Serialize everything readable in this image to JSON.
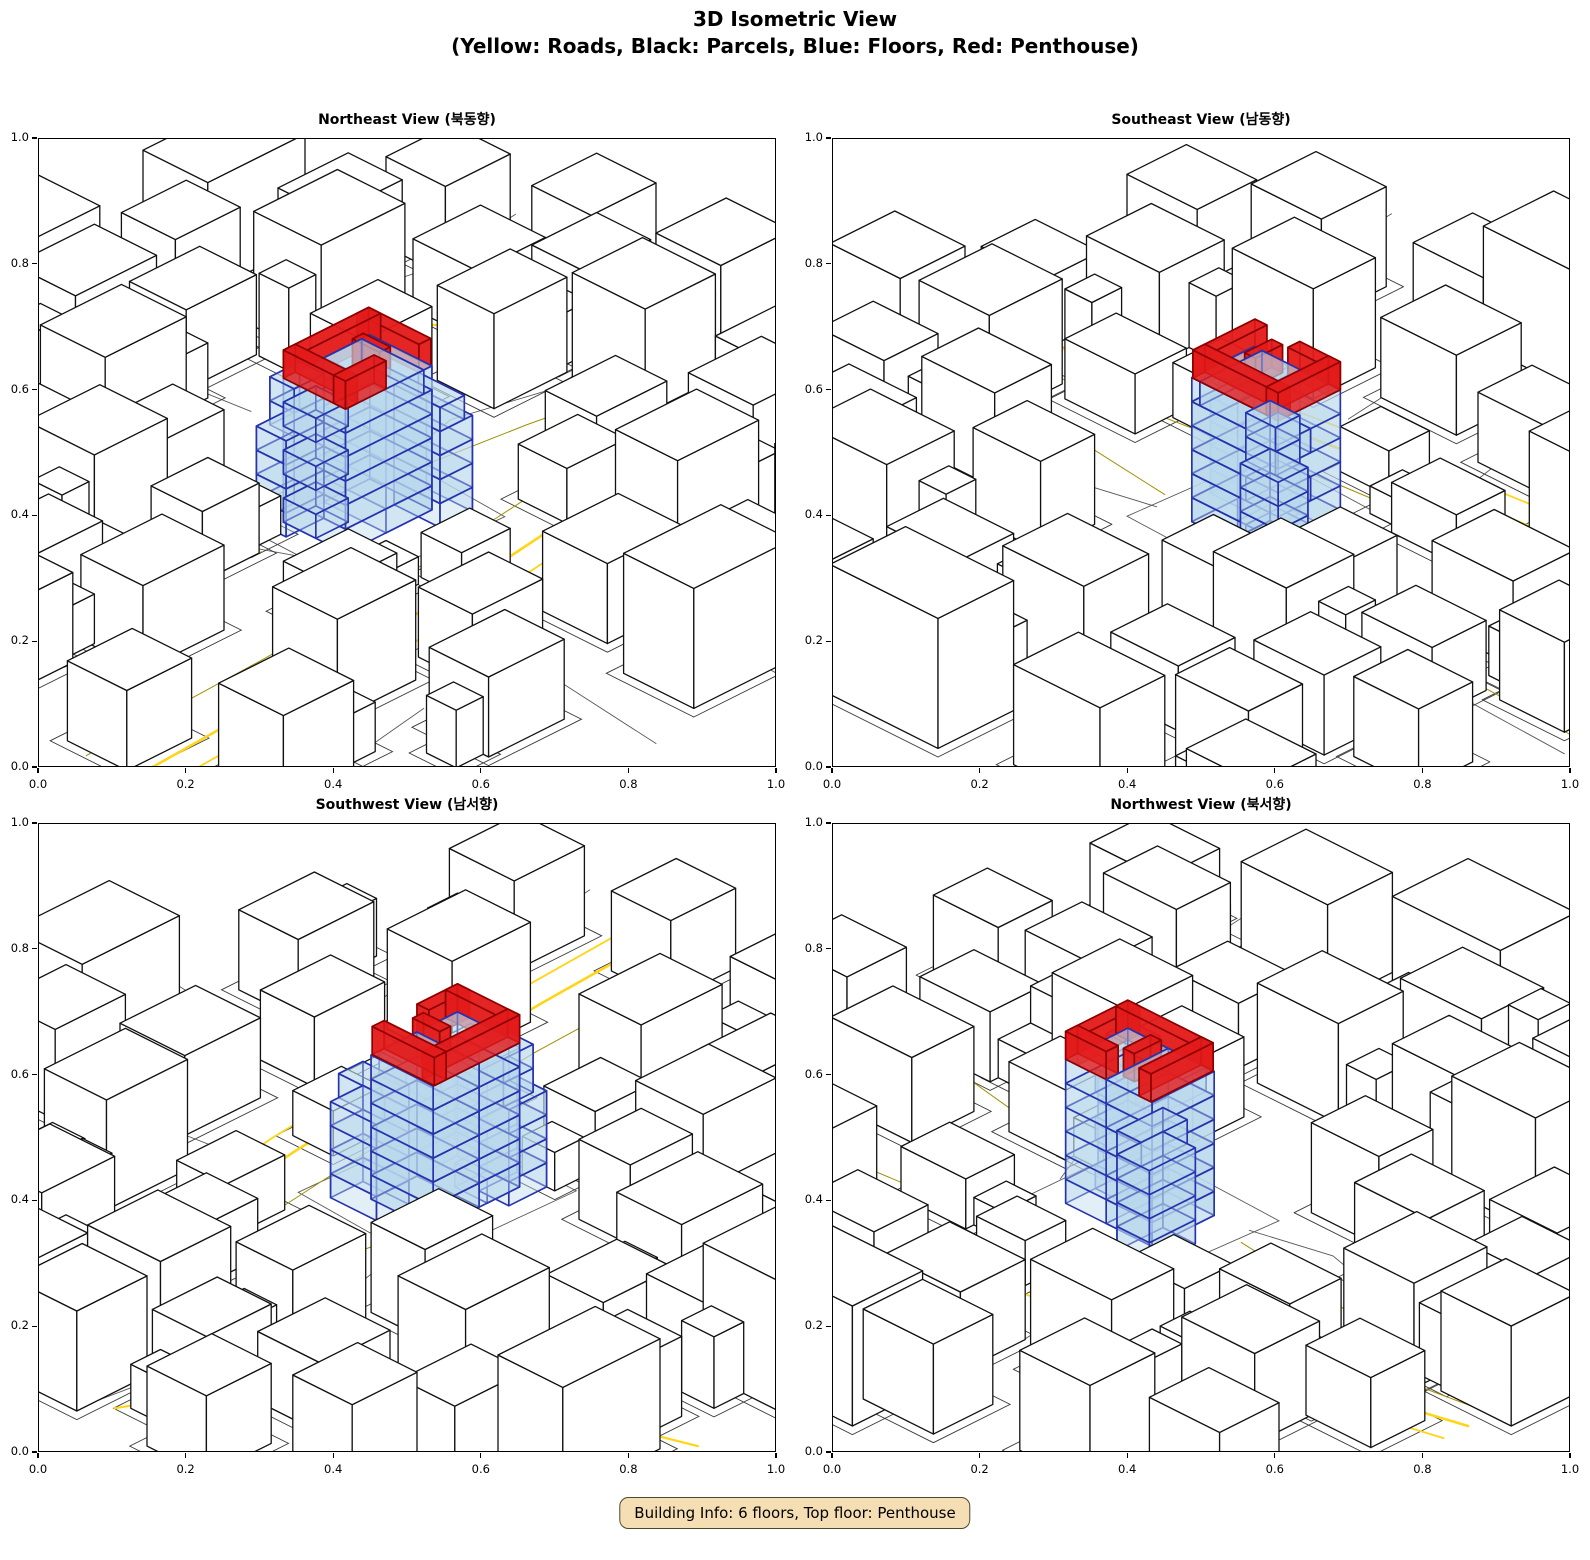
{
  "figure": {
    "title_line1": "3D Isometric View",
    "title_line2": "(Yellow: Roads, Black: Parcels, Blue: Floors, Red: Penthouse)",
    "footer_badge": "Building Info: 6 floors, Top floor: Penthouse"
  },
  "building_info": {
    "floors": 6,
    "top_floor": "Penthouse"
  },
  "subplots": [
    {
      "title": "Northeast View (북동향)",
      "view": "northeast"
    },
    {
      "title": "Southeast View (남동향)",
      "view": "southeast"
    },
    {
      "title": "Southwest View (남서향)",
      "view": "southwest"
    },
    {
      "title": "Northwest View (북서향)",
      "view": "northwest"
    }
  ],
  "axes": {
    "tick_values": [
      0,
      0.2,
      0.4,
      0.6,
      0.8,
      1.0
    ],
    "x_tick_labels": [
      "0.0",
      "0.2",
      "0.4",
      "0.6",
      "0.8",
      "1.0"
    ],
    "y_tick_labels": [
      "0.0",
      "0.2",
      "0.4",
      "0.6",
      "0.8",
      "1.0"
    ]
  },
  "colors": {
    "road_gold": "#FFD517",
    "road_olive": "#A08F00",
    "parcel_line": "#3a3a3a",
    "parcel_gray": "#5a5a5a",
    "building_fill": "#FFFFFF",
    "building_edge": "#111111",
    "floor_fill": "#BBD9EC",
    "floor_edge": "#2633AD",
    "penthouse_fill": "#E31B1B",
    "penthouse_edge": "#8F0000",
    "frame_color": "#000000",
    "badge_bg": "#F5DEB3",
    "badge_border": "#4A4A2A"
  }
}
